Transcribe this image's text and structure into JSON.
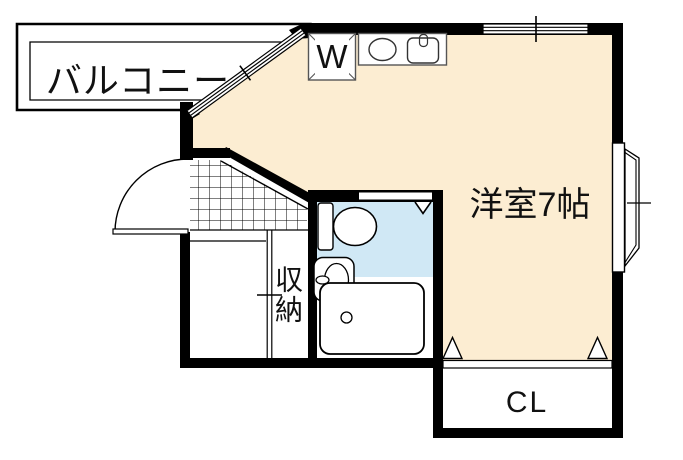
{
  "floorplan": {
    "kind": "japanese-apartment-floor-plan",
    "labels": {
      "balcony": "バルコニー",
      "washer": "W",
      "main_room": "洋室7帖",
      "storage": "収納",
      "closet": "CL"
    },
    "colors": {
      "room_fill": "#FCEDD2",
      "bathroom_fill": "#D0E8F5",
      "wall": "#000000",
      "background": "#FFFFFF"
    },
    "fixtures": [
      "washing-machine-pan",
      "stove-burner",
      "kitchen-sink",
      "toilet",
      "washbasin",
      "bathtub",
      "entry-door",
      "bay-window",
      "balcony-window",
      "wall-window",
      "storage-sliding-door",
      "bathroom-door",
      "closet-folding-door",
      "entrance-tile"
    ]
  }
}
